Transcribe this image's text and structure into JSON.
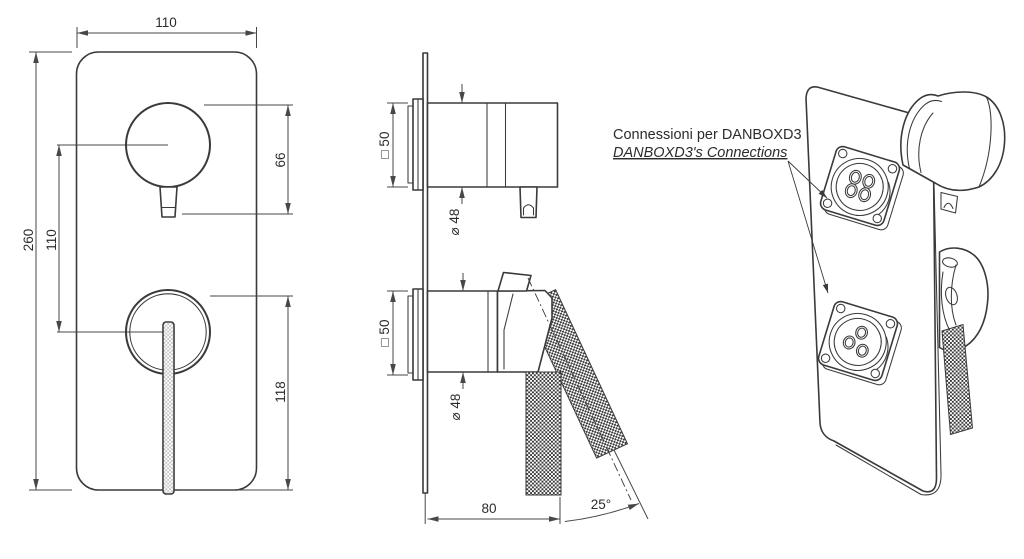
{
  "annotation": {
    "line1": "Connessioni per DANBOXD3",
    "line2": "DANBOXD3's Connections"
  },
  "front_view": {
    "width": "110",
    "height": "260",
    "handle_spacing": "110",
    "upper_knob_height": "66",
    "lower_handle_length": "118"
  },
  "side_view": {
    "upper_flange_square": "□ 50",
    "upper_knob_diameter": "⌀ 48",
    "lower_flange_square": "□ 50",
    "lower_knob_diameter": "⌀ 48",
    "projection_depth": "80",
    "handle_angle": "25°"
  },
  "colors": {
    "line": "#3a3a3a",
    "dim_line": "#474747",
    "text": "#2c2c2c",
    "background": "#ffffff"
  }
}
